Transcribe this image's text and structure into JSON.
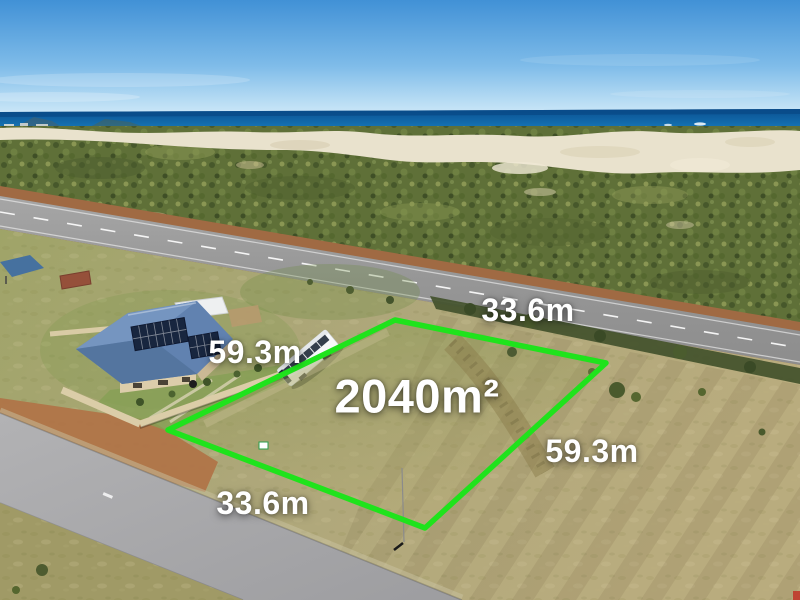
{
  "photo": {
    "description": "Aerial drone photo of a vacant coastal building lot outlined in green beside a highway, ocean and dunes behind"
  },
  "labels": {
    "area": "2040m²",
    "top_edge": "33.6m",
    "right_edge": "59.3m",
    "bottom_edge": "33.6m",
    "left_edge": "59.3m"
  },
  "colors": {
    "boundary_green": "#1fe31c",
    "label_text": "#ffffff"
  }
}
